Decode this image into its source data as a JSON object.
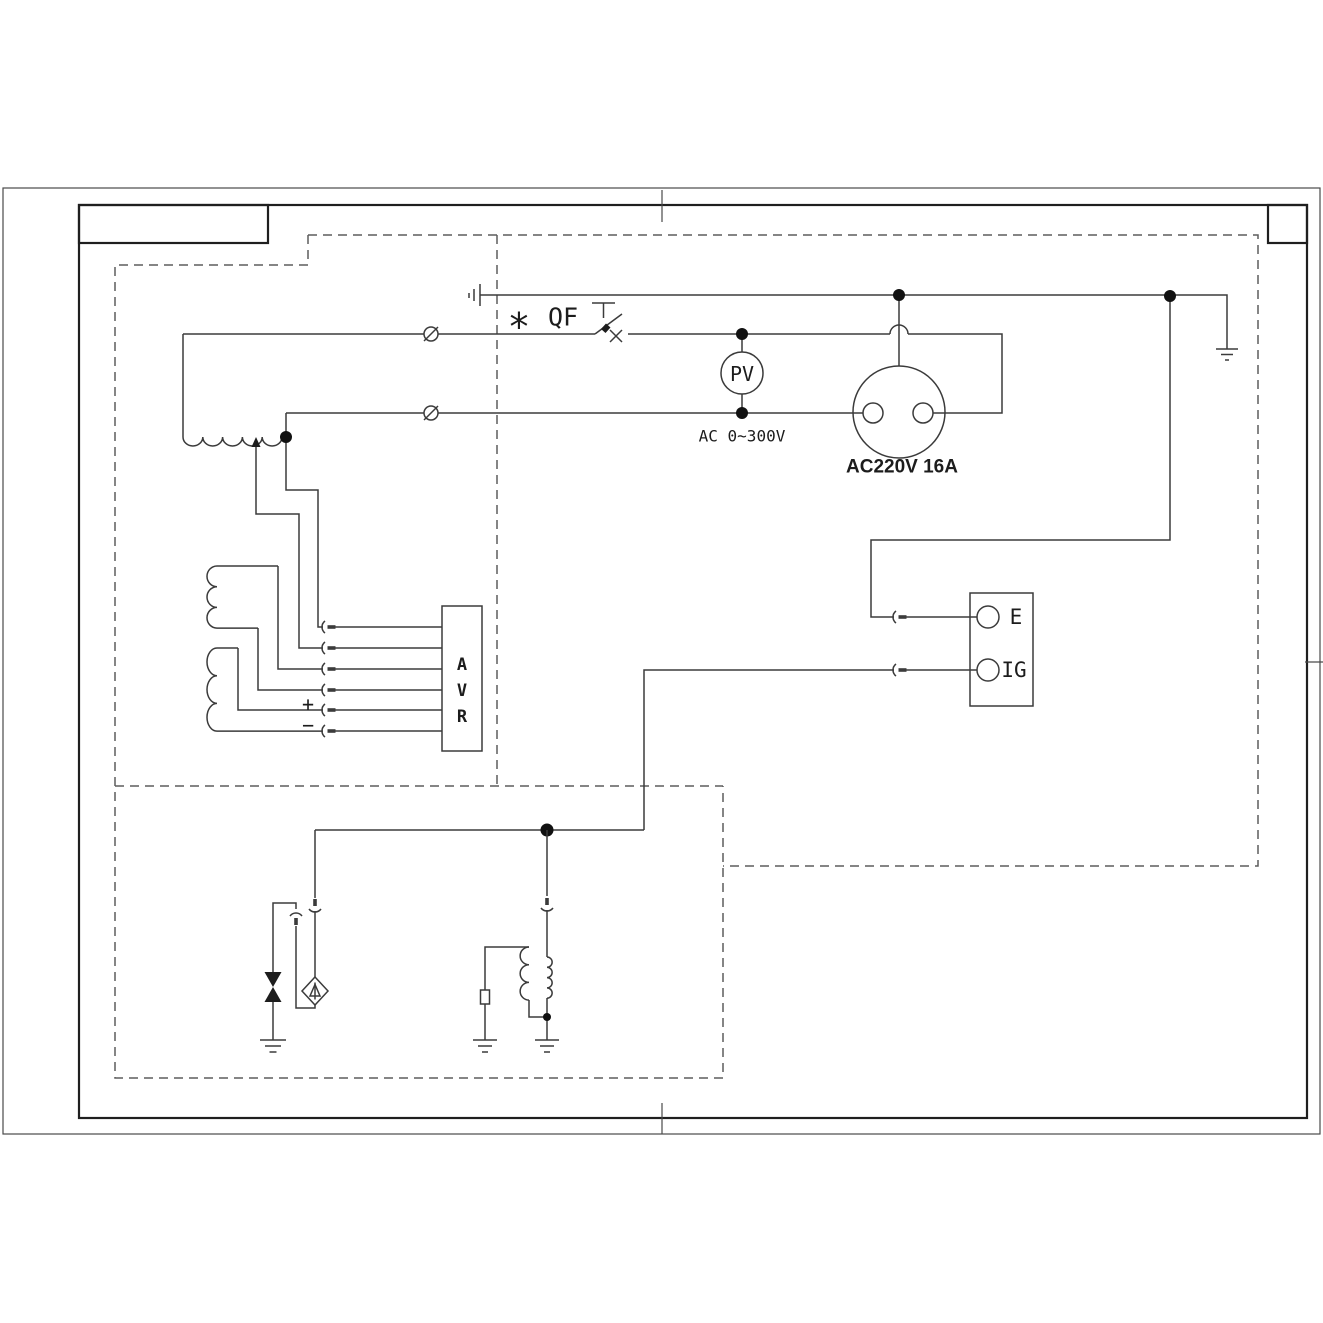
{
  "page": {
    "background_color": "#ffffff",
    "line_color": "#3b3b3b",
    "frame_color": "#1f1f1f",
    "dash_color": "#5d5d5d"
  },
  "diagram": {
    "labels": {
      "phase_star": "*",
      "breaker": "QF",
      "voltmeter": "PV",
      "voltmeter_range": "AC 0~300V",
      "socket_rating": "AC220V 16A",
      "terminal_e": "E",
      "terminal_ig": "IG",
      "avr_letters": [
        "A",
        "V",
        "R"
      ],
      "dc_plus": "+",
      "dc_minus": "−"
    }
  }
}
